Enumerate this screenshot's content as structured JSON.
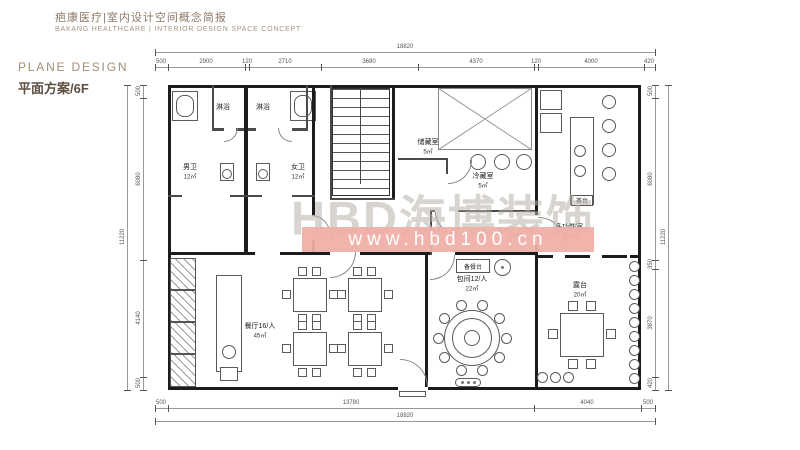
{
  "header": {
    "title_zh": "疤康医疗|室内设计空间概念简报",
    "title_en": "BAKANG HEALTHCARE | INTERIOR DESIGN SPACE CONCEPT"
  },
  "section": {
    "label_en": "PLANE DESIGN",
    "label_zh": "平面方案/6F"
  },
  "watermark": {
    "brand": "HBD海博装饰",
    "url": "www.hbd100.cn"
  },
  "rooms": {
    "mens_wc": {
      "name": "男卫",
      "area": "12㎡"
    },
    "womens_wc": {
      "name": "女卫",
      "area": "12㎡"
    },
    "shower_left": {
      "name": "淋浴"
    },
    "shower_right": {
      "name": "淋浴"
    },
    "storage": {
      "name": "储藏室",
      "area": "5㎡"
    },
    "cold_storage": {
      "name": "冷藏室",
      "area": "5㎡"
    },
    "tea_station": {
      "name": "茶台"
    },
    "multi_room": {
      "name": "多功能室",
      "area": "25㎡"
    },
    "terrace": {
      "name": "露台",
      "area": "20㎡"
    },
    "serving_counter": {
      "name": "备餐台"
    },
    "private_room": {
      "name": "包间12/人",
      "area": "22㎡"
    },
    "dining_hall": {
      "name": "餐厅16/人",
      "area": "45㎡"
    }
  },
  "dims": {
    "top_overall": "18820",
    "top_chain": [
      "500",
      "2900",
      "120",
      "2710",
      "3680",
      "4370",
      "120",
      "4000",
      "420"
    ],
    "bottom_chain": [
      "500",
      "13780",
      "4040",
      "500"
    ],
    "bottom_overall": "18820",
    "left_overall": "11220",
    "left_chain": [
      "500",
      "6080",
      "4140",
      "500"
    ],
    "right_chain": [
      "500",
      "6080",
      "350",
      "3870",
      "420"
    ],
    "right_overall": "11220"
  },
  "colors": {
    "heading": "#5d4f41",
    "title": "#8a7968",
    "subtitle": "#a3957f",
    "watermark_band": "#f0b0a8",
    "watermark_text": "#b8b0a8",
    "wall": "#1c1c1c"
  }
}
